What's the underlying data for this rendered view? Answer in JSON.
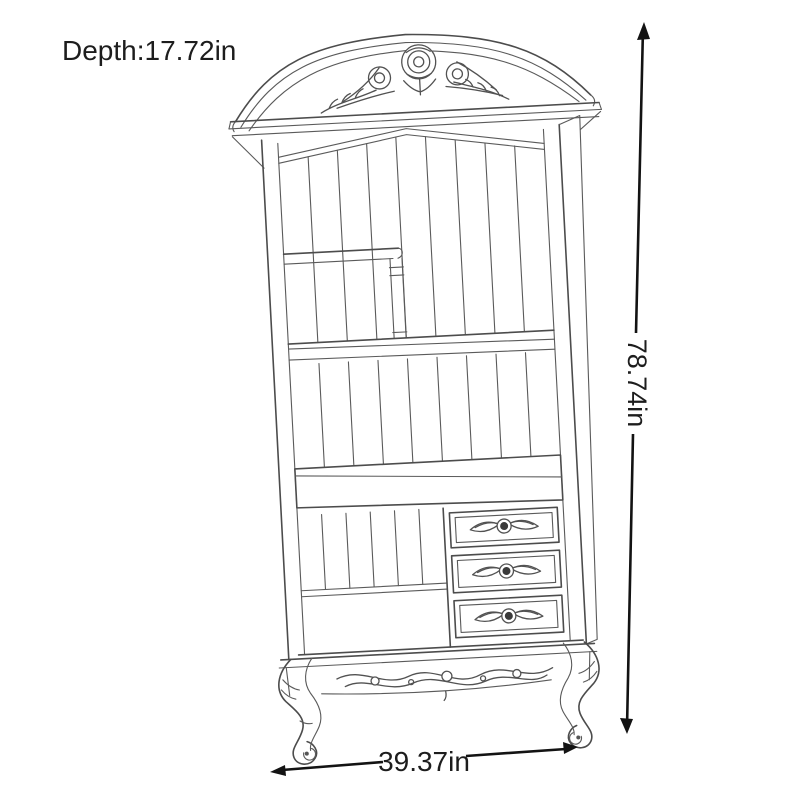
{
  "canvas": {
    "width": 800,
    "height": 800,
    "background_color": "#ffffff"
  },
  "figure": {
    "name": "ornate-bookcase-line-drawing",
    "subject": "French-style bookcase with carved crown, slatted back, shelves, three drawers, carved apron and cabriole legs",
    "line_color": "#4c4c4c",
    "detail_color": "#5a5a5a",
    "knob_color": "#3a3a3a"
  },
  "dimensions": {
    "text_color": "#1d1d1d",
    "line_color": "#131313",
    "depth": {
      "label": "Depth:17.72in"
    },
    "height": {
      "label": "78.74in"
    },
    "width": {
      "label": "39.37in"
    }
  },
  "icons": {
    "up_arrow": "arrow-up-icon",
    "down_arrow": "arrow-down-icon",
    "left_arrow": "arrow-left-icon",
    "right_arrow": "arrow-right-icon"
  }
}
